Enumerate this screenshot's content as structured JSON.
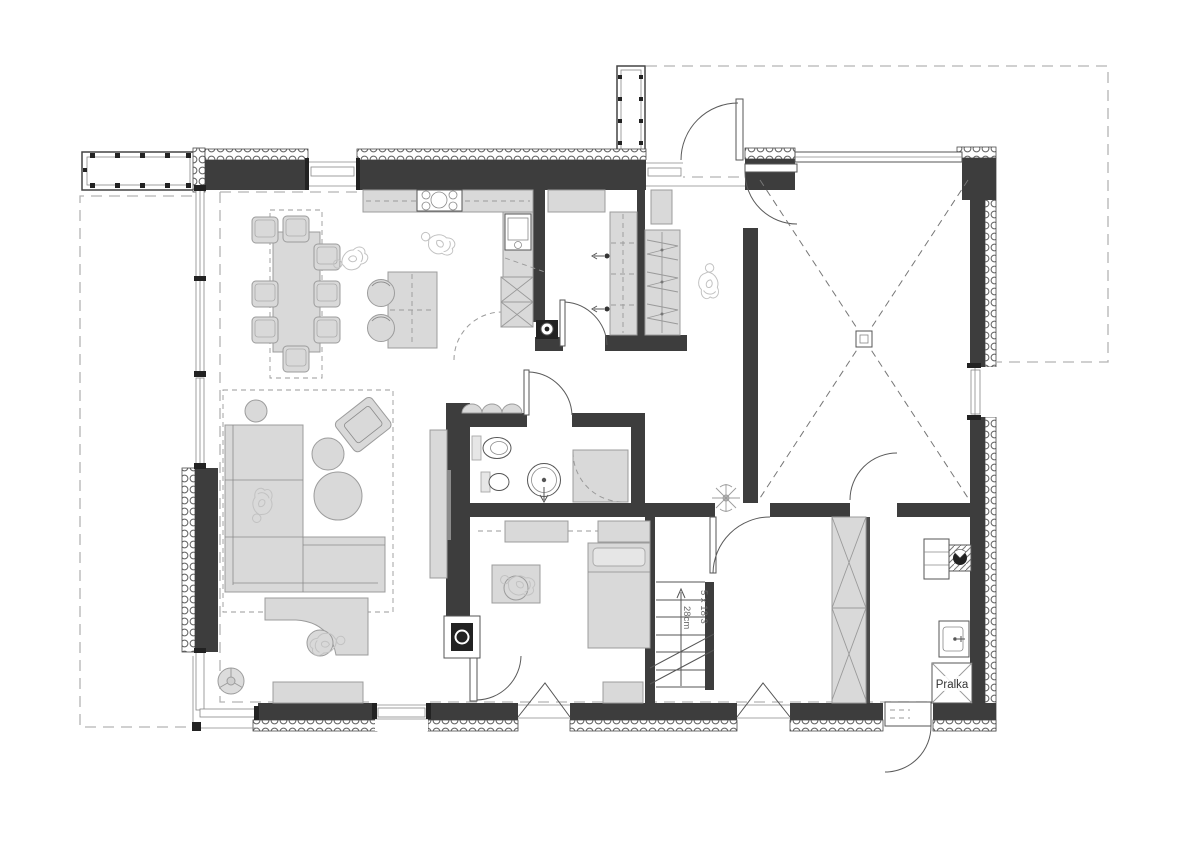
{
  "labels": {
    "washing_machine": "Pralka",
    "stairs_riser": "5 x 18,3",
    "stairs_tread": "28cm"
  },
  "colors": {
    "wall": "#3d3d3d",
    "furniture_fill": "#d9d9d9",
    "furniture_stroke": "#9c9c9c",
    "dashed_line": "#b3b3b3",
    "background": "#ffffff"
  },
  "symbols": [
    "dining-table",
    "dining-chair",
    "kitchen-counter",
    "cooktop",
    "kitchen-sink",
    "tall-cabinet",
    "kitchen-island",
    "bar-stool",
    "pantry-shelves",
    "hall-wardrobe",
    "sofa",
    "armchair",
    "pouf",
    "tv-sideboard",
    "fireplace",
    "desk",
    "office-chair",
    "sideboard",
    "plant",
    "toilet",
    "bidet-sink",
    "shower-drain",
    "shower-tray",
    "bed",
    "dresser",
    "stairs",
    "direction-arrow",
    "garage-cross",
    "floor-drain",
    "boiler",
    "flue-box",
    "utility-sink",
    "washing-machine",
    "door-swing-arc",
    "window",
    "insulation-hatch",
    "roof-overhang-dashed",
    "terrace-outline-dashed",
    "person-figure",
    "chimney",
    "railing"
  ]
}
